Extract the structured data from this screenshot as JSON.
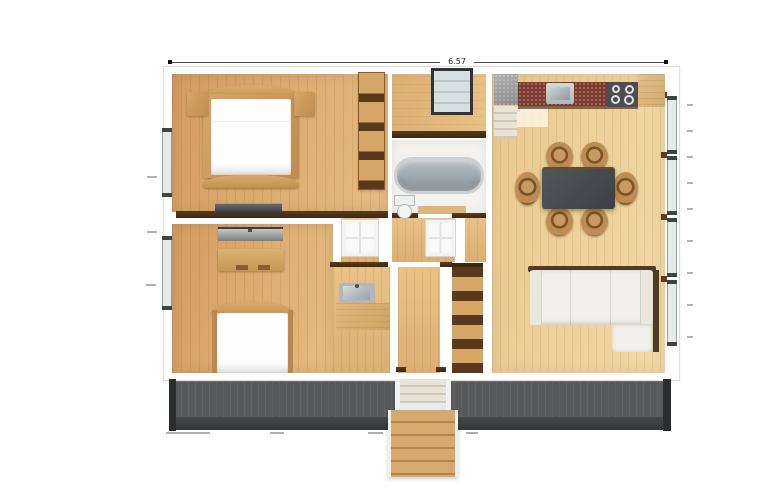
{
  "meta": {
    "title": "apartment-floor-plan-render",
    "view": "top-down"
  },
  "annotations": {
    "top_dimension": "6.57"
  },
  "palette": {
    "pageBg": "#ffffff",
    "wall": "#ffffff",
    "wallEdge": "#e0ddd8",
    "floorBedA": "#d49c60",
    "floorBedB": "#e6bc82",
    "floorHallA": "#dcae72",
    "floorHallB": "#e9c287",
    "floorLivA": "#eac88f",
    "floorLivB": "#f2d8a6",
    "bathFloor": "#f3f2ef",
    "trimBrown": "#4f301a",
    "furnWoodA": "#d5a766",
    "furnWoodB": "#c08c4e",
    "shelfDark": "#5b371c",
    "mattress": "#fdfdfd",
    "doorWhite": "#f9f9f9",
    "glass": "#cdd8dc",
    "frameDark": "#303436",
    "windowGlass": "#e7eaea",
    "sillBrown": "#5d3a20",
    "counterGrayA": "#b0b0b0",
    "counterGrayB": "#8a8a8a",
    "counterRed": "#7c3a2f",
    "stoveDark": "#4a4d51",
    "steelA": "#d6d9da",
    "steelB": "#b2b6b8",
    "tubA": "#b6bec2",
    "tubB": "#98a2a7",
    "tableDark": "#45494e",
    "chairWood": "#bd8d55",
    "sofaWhite": "#f1f0e9",
    "sofaBack": "#4e3a27",
    "grayUnitA": "#c6c6c6",
    "grayUnitB": "#7d7f80",
    "deckGray": "#58595a",
    "deckFasciaA": "#47484a",
    "deckFasciaB": "#353637",
    "deckPost": "#2b2c2d",
    "stairA": "#d6a96e",
    "stairB": "#b9854a",
    "stepLightA": "#e9e3d8",
    "stepLightB": "#cfc7b8",
    "dimLine": "#4a4a4a",
    "dimText": "#222222",
    "tick": "#b3b0ab"
  },
  "rooms": [
    {
      "id": "bedroom-1",
      "furniture": [
        "double-bed",
        "nightstand-left",
        "nightstand-right",
        "wardrobe-shelves",
        "low-dresser"
      ]
    },
    {
      "id": "bedroom-2",
      "furniture": [
        "media-console",
        "desk",
        "single-bed"
      ]
    },
    {
      "id": "hallway-top",
      "furniture": [
        "glazed-window-panel"
      ]
    },
    {
      "id": "bathroom",
      "furniture": [
        "bathtub",
        "toilet"
      ]
    },
    {
      "id": "hall",
      "furniture": [
        "door-left",
        "door-right"
      ]
    },
    {
      "id": "wc",
      "furniture": [
        "washbasin",
        "counter"
      ]
    },
    {
      "id": "living-dining-kitchen",
      "furniture": [
        "gray-counter",
        "entry-steps",
        "red-stone-counter",
        "kitchen-sink",
        "cooktop",
        "wood-counter",
        "dining-table",
        "dining-chairs-6",
        "sectional-sofa",
        "open-shelving"
      ]
    },
    {
      "id": "deck",
      "furniture": [
        "deck-boards",
        "deck-steps",
        "outdoor-stairs"
      ]
    }
  ]
}
